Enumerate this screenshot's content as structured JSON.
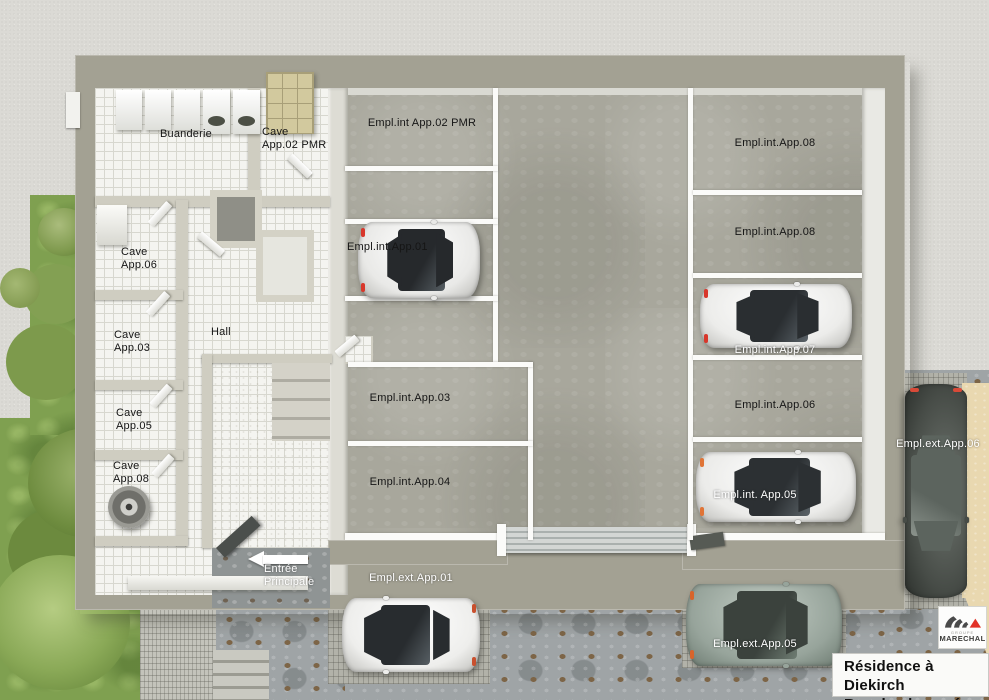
{
  "plan": {
    "type": "3D rendered ground-floor plan",
    "rooms": {
      "buanderie": "Buanderie",
      "cave_app02_pmr": "Cave\nApp.02 PMR",
      "cave_app06": "Cave\nApp.06",
      "cave_app03": "Cave\nApp.03",
      "cave_app05": "Cave\nApp.05",
      "cave_app08": "Cave\nApp.08",
      "hall": "Hall"
    },
    "parking": {
      "interior": [
        {
          "id": "empl-int-app02-pmr",
          "label": "Empl.int App.02 PMR"
        },
        {
          "id": "empl-int-app01",
          "label": "Empl.int.App.01"
        },
        {
          "id": "empl-int-app03",
          "label": "Empl.int.App.03"
        },
        {
          "id": "empl-int-app04",
          "label": "Empl.int.App.04"
        },
        {
          "id": "empl-int-app08-top",
          "label": "Empl.int.App.08"
        },
        {
          "id": "empl-int-app08-mid",
          "label": "Empl.int.App.08"
        },
        {
          "id": "empl-int-app07",
          "label": "Empl.int.App.07"
        },
        {
          "id": "empl-int-app06",
          "label": "Empl.int.App.06"
        },
        {
          "id": "empl-int-app05",
          "label": "Empl.int. App.05"
        }
      ],
      "exterior": [
        {
          "id": "empl-ext-app01",
          "label": "Empl.ext.App.01"
        },
        {
          "id": "empl-ext-app05",
          "label": "Empl.ext.App.05"
        },
        {
          "id": "empl-ext-app06",
          "label": "Empl.ext.App.06"
        }
      ]
    },
    "entrance": {
      "label": "Entrée\nPrincipale"
    }
  },
  "title_block": {
    "line1": "Résidence à Diekirch",
    "line2": "Rez-de-chaussée"
  },
  "logo": {
    "group": "GROUPE",
    "name": "MARECHAL",
    "red": "#e23227",
    "gray": "#4a4a4a"
  },
  "palette": {
    "outer_wall": "#a3a193",
    "interior_tile": "#f4f4f0",
    "garage_floor": "#a8a79c",
    "driveway": "#9fa4a6",
    "gravel": "#dbdad5",
    "grass": "#7fa050",
    "paver_pad": "#b2b2a9",
    "beige_area": "#e9d8b0",
    "parking_marking": "#ffffff"
  }
}
